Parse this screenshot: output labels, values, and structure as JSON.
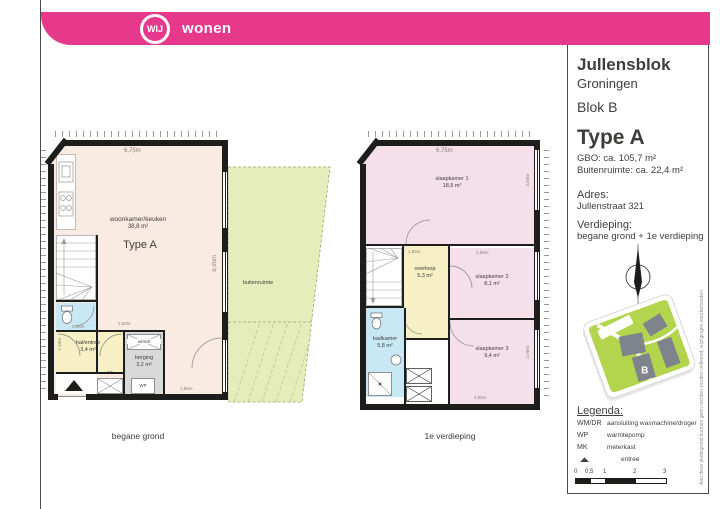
{
  "brand": {
    "circle_text": "WIJ",
    "wordmark": "wonen",
    "color": "#e6398b"
  },
  "sidebar": {
    "project": "Jullensblok",
    "city": "Groningen",
    "block": "Blok B",
    "type": "Type A",
    "gbo": "GBO: ca. 105,7 m²",
    "buitenruimte": "Buitenruimte: ca. 22,4 m²",
    "address_label": "Adres:",
    "address": "Jullenstraat 321",
    "floor_label": "Verdieping:",
    "floor": "begane grond + 1e verdieping",
    "map_marker": "B",
    "legend": {
      "title": "Legenda:",
      "items": [
        {
          "abbr": "WM/DR",
          "label": "aansluiting wasmachine/droger"
        },
        {
          "abbr": "WP",
          "label": "warmtepomp"
        },
        {
          "abbr": "MK",
          "label": "meterkast"
        },
        {
          "abbr": "▲",
          "label": "entree"
        }
      ]
    },
    "scale": {
      "ticks": [
        "0",
        "0,5",
        "1",
        "2",
        "3"
      ]
    },
    "disclaimer": "Aan deze plattegrond kunnen geen rechten worden ontleend, wijzigingen voorbehouden"
  },
  "plans": {
    "ground": {
      "caption": "begane grond",
      "type_label": "Type A",
      "outdoor_label": "buitenruimte",
      "rooms": {
        "living": {
          "name": "woonkamer/keuken",
          "area": "38,8 m²"
        },
        "hall": {
          "name": "hal/entree",
          "area": "3,4 m²"
        },
        "storage": {
          "name": "berging",
          "area": "3,2 m²"
        }
      },
      "fixtures": {
        "wm_dr": "wm/dr",
        "mk": "mk",
        "wp": "WP"
      },
      "dims": {
        "top": "6,75m",
        "right": "8,95m",
        "hall_top": "2,66m",
        "storage_top": "2,50m",
        "hall_left": "1,40m",
        "bottom": "1,86m"
      }
    },
    "first": {
      "caption": "1e verdieping",
      "rooms": {
        "bedroom1": {
          "name": "slaapkamer 1",
          "area": "18,5 m²"
        },
        "landing": {
          "name": "overloop",
          "area": "5,3 m²"
        },
        "bedroom2": {
          "name": "slaapkamer 2",
          "area": "8,1 m²"
        },
        "bathroom": {
          "name": "badkamer",
          "area": "5,8 m²"
        },
        "bedroom3": {
          "name": "slaapkamer 3",
          "area": "9,4 m²"
        }
      },
      "dims": {
        "top": "6,75m",
        "bed1_right": "3,03m",
        "landing_top": "1,86m",
        "bed2_top": "2,66m",
        "bed3_right": "2,95m",
        "bottom": "3,05m"
      }
    }
  }
}
